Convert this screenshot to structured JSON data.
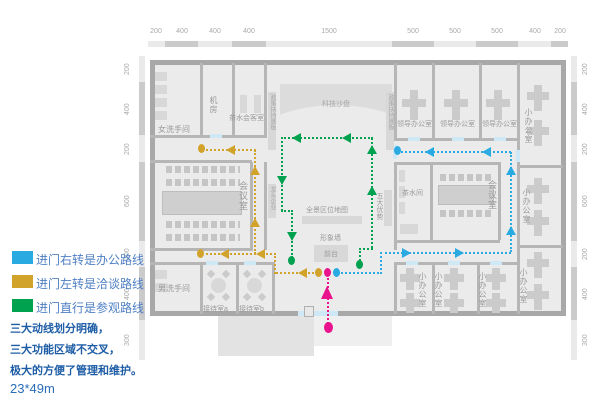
{
  "colors": {
    "office": "#29abe2",
    "negotiation": "#d2a32b",
    "visit": "#00a14f",
    "entrance": "#e9138d",
    "legendText": "#4e7fc4",
    "noteText": "#1e5da6"
  },
  "legend": {
    "items": [
      {
        "color": "#29abe2",
        "label": "进门右转是办公路线"
      },
      {
        "color": "#d2a32b",
        "label": "进门左转是洽谈路线"
      },
      {
        "color": "#00a14f",
        "label": "进门直行是参观路线"
      }
    ]
  },
  "notes": {
    "line1": "三大动线划分明确，",
    "line2": "三大功能区域不交叉，",
    "line3": "极大的方便了管理和维护。",
    "size": "23*49m"
  },
  "dimensions": {
    "top": [
      "200",
      "400",
      "400",
      "400",
      "1500",
      "500",
      "500",
      "500",
      "400",
      "200"
    ],
    "left": [
      "200",
      "400",
      "200",
      "600",
      "200",
      "400",
      "300"
    ],
    "right": [
      "200",
      "400",
      "200",
      "600",
      "200",
      "400",
      "300"
    ]
  },
  "rooms": {
    "women_wc": "女洗手间",
    "machine_room": "机房",
    "tea_meeting": "茶水会客室",
    "sand_table": "科技沙盘",
    "board_policy": "政策扶持展板",
    "leader_office": "领导办公室",
    "small_office": "小办公室",
    "meeting_room": "会议室",
    "tea_room": "茶水间",
    "leading_wall": "龙头企业",
    "advantages_wall": "五大优势",
    "map_wall": "全景区位地图",
    "image_wall": "形象墙",
    "front_desk": "前台",
    "men_wc": "男洗手间",
    "reception_a": "接待室a",
    "reception_b": "接待室b"
  }
}
